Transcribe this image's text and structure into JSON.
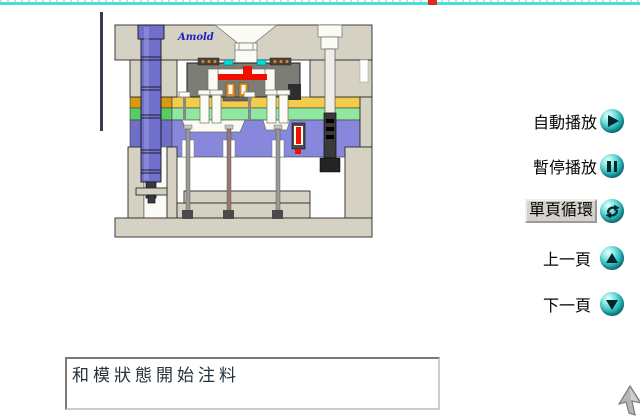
{
  "window": {
    "width": 640,
    "height": 419,
    "background": "#ffffff"
  },
  "marquee": {
    "line_color": "#42e2e2",
    "dash_color": "#dd2b1e"
  },
  "diagram": {
    "brand": "Amold",
    "description": "injection-mold cross-section animation frame",
    "colors": {
      "plate": "#d5d2c3",
      "plate-stroke": "#2b2b28",
      "cavity": "#7d7d78",
      "melt-red": "#ee1100",
      "band-orange": "#d89a10",
      "band-yellow": "#f2cc4a",
      "band-green-dark": "#55cc66",
      "band-green": "#90e8a0",
      "band-purple-dark": "#6f6fc8",
      "band-purple": "#8787dc",
      "guide-pin-blue": "#7070cc",
      "cyan-insert": "#00dddd",
      "insert-orange": "#e08820",
      "pin-gray": "#9a9a94",
      "dark-metal": "#3a3a3a",
      "white-part": "#fbfbf6",
      "brand-blue": "#2222bb"
    }
  },
  "menu": {
    "button_color": "#15a0a0",
    "items": [
      {
        "label": "自動播放",
        "icon": "play",
        "selected": false
      },
      {
        "label": "暫停播放",
        "icon": "pause",
        "selected": false
      },
      {
        "label": "單頁循環",
        "icon": "loop",
        "selected": true
      },
      {
        "label": "上一頁",
        "icon": "page-up",
        "selected": false
      },
      {
        "label": "下一頁",
        "icon": "page-down",
        "selected": false
      }
    ]
  },
  "status_box": {
    "text": "和模狀態開始注料"
  },
  "cursor": {
    "type": "arrow"
  }
}
